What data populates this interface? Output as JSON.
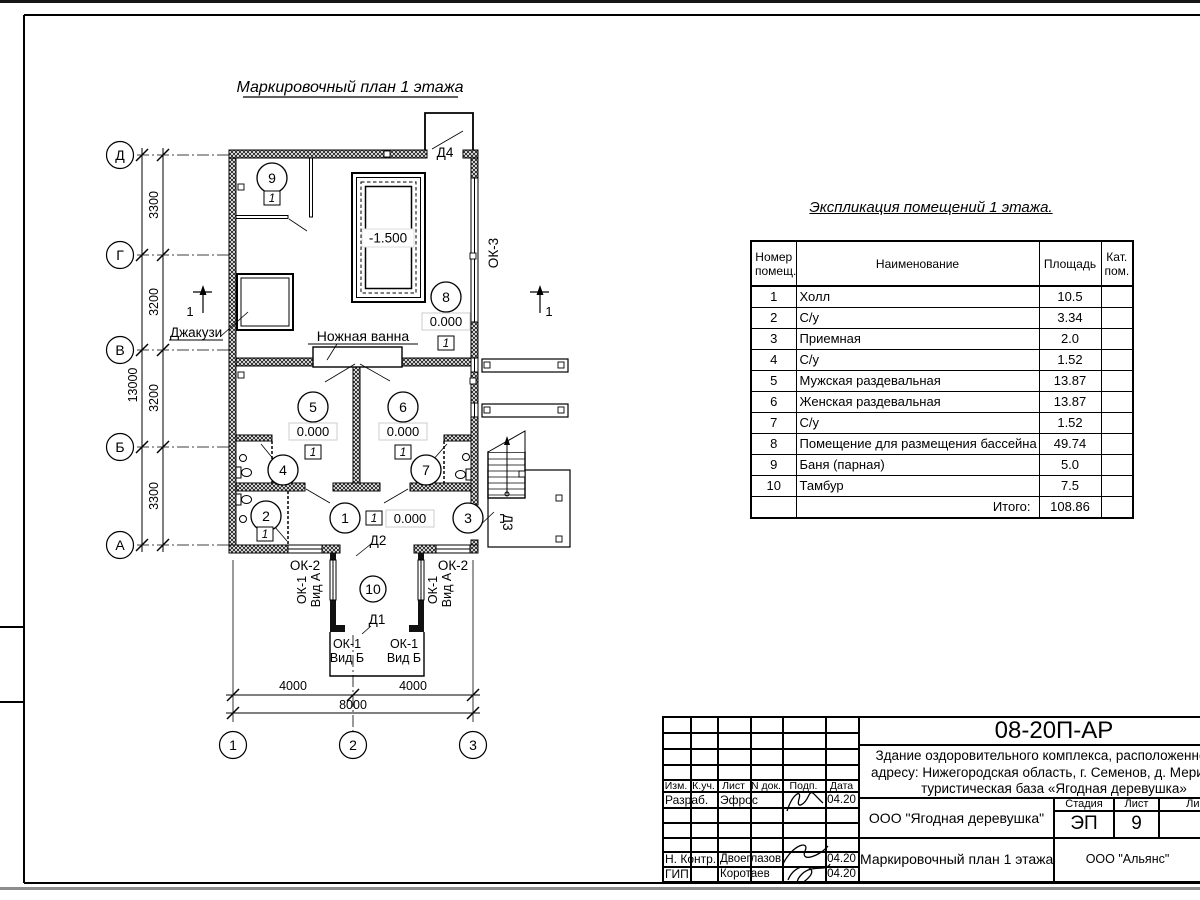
{
  "plan": {
    "title": "Маркировочный план 1 этажа",
    "row_axes": [
      "Д",
      "Г",
      "В",
      "Б",
      "А"
    ],
    "col_axes": [
      "1",
      "2",
      "3"
    ],
    "dims_left": [
      "3300",
      "3200",
      "3200",
      "3300"
    ],
    "dims_left_total": "13000",
    "dims_bottom": [
      "4000",
      "4000"
    ],
    "dims_bottom_total": "8000",
    "room_numbers": [
      "1",
      "2",
      "3",
      "4",
      "5",
      "6",
      "7",
      "8",
      "9",
      "10"
    ],
    "elevation_zero": "0.000",
    "elevation_pool": "-1.500",
    "floor_type_mark": "1",
    "section_mark": "1",
    "labels": {
      "jacuzzi": "Джакузи",
      "foot_bath": "Ножная ванна",
      "door_1": "Д1",
      "door_2": "Д2",
      "door_3": "Д3",
      "door_4": "Д4",
      "window_ok1": "ОК-1",
      "window_ok2": "ОК-2",
      "window_ok3": "ОК-3",
      "view_a": "Вид А",
      "view_b": "Вид Б"
    }
  },
  "explication": {
    "title": "Экспликация помещений 1 этажа.",
    "headers": {
      "num_l1": "Номер",
      "num_l2": "помещ.",
      "name": "Наименование",
      "area": "Площадь",
      "cat_l1": "Кат.",
      "cat_l2": "пом."
    },
    "rows": [
      {
        "num": "1",
        "name": "Холл",
        "area": "10.5"
      },
      {
        "num": "2",
        "name": "С/у",
        "area": "3.34"
      },
      {
        "num": "3",
        "name": "Приемная",
        "area": "2.0"
      },
      {
        "num": "4",
        "name": "С/у",
        "area": "1.52"
      },
      {
        "num": "5",
        "name": "Мужская раздевальная",
        "area": "13.87"
      },
      {
        "num": "6",
        "name": "Женская раздевальная",
        "area": "13.87"
      },
      {
        "num": "7",
        "name": "С/у",
        "area": "1.52"
      },
      {
        "num": "8",
        "name": "Помещение для размещения бассейна",
        "area": "49.74"
      },
      {
        "num": "9",
        "name": "Баня (парная)",
        "area": "5.0"
      },
      {
        "num": "10",
        "name": "Тамбур",
        "area": "7.5"
      }
    ],
    "total_label": "Итого:",
    "total": "108.86"
  },
  "titleblock": {
    "doc_number": "08-20П-АР",
    "description_l1": "Здание оздоровительного комплекса, расположенное по",
    "description_l2": "адресу: Нижегородская область, г. Семенов, д. Мериново,",
    "description_l3": "туристическая база «Ягодная деревушка»",
    "cols": {
      "izm": "Изм.",
      "kuch": "К.уч.",
      "list": "Лист",
      "ndoc": "N док.",
      "podp": "Подп.",
      "data": "Дата"
    },
    "sign_rows": [
      {
        "role": "Разраб.",
        "name": "Эфрос",
        "date": "04.20"
      },
      {
        "role": "Н. Контр.",
        "name": "Двоеглазов",
        "date": "04.20"
      },
      {
        "role": "ГИП",
        "name": "Коротаев",
        "date": "04.20"
      }
    ],
    "org": "ООО \"Ягодная деревушка\"",
    "stage_label": "Стадия",
    "sheet_label": "Лист",
    "sheets_label": "Листов",
    "stage": "ЭП",
    "sheet_num": "9",
    "drawing_title": "Маркировочный план 1 этажа",
    "contractor": "ООО \"Альянс\""
  }
}
